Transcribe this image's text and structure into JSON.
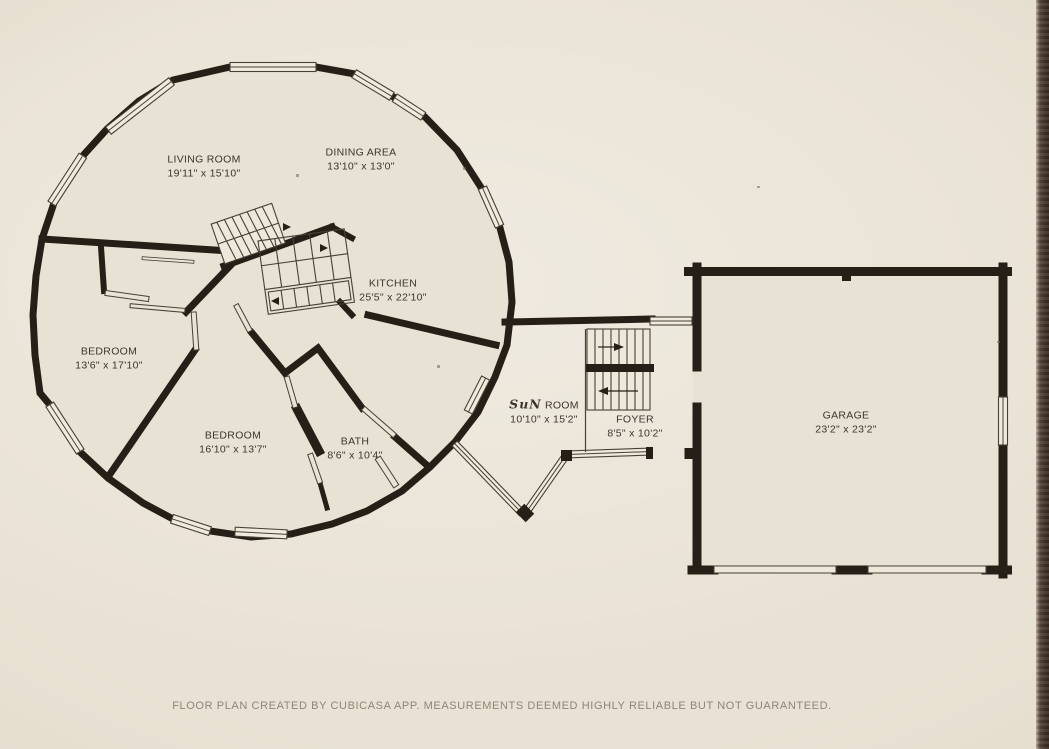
{
  "rooms": {
    "living_room": {
      "label": "LIVING ROOM",
      "dims": "19'11\" x 15'10\""
    },
    "dining_area": {
      "label": "DINING AREA",
      "dims": "13'10\" x 13'0\""
    },
    "kitchen": {
      "label": "KITCHEN",
      "dims": "25'5\" x 22'10\""
    },
    "bedroom_left": {
      "label": "BEDROOM",
      "dims": "13'6\" x 17'10\""
    },
    "bedroom_bottom": {
      "label": "BEDROOM",
      "dims": "16'10\" x 13'7\""
    },
    "bath": {
      "label": "BATH",
      "dims": "8'6\" x 10'4\""
    },
    "sun_room": {
      "label_hand": "SuN",
      "label": "ROOM",
      "dims": "10'10\" x 15'2\""
    },
    "foyer": {
      "label": "FOYER",
      "dims": "8'5\" x 10'2\""
    },
    "garage": {
      "label": "GARAGE",
      "dims": "23'2\" x 23'2\""
    }
  },
  "footer": "FLOOR PLAN CREATED BY CUBICASA APP. MEASUREMENTS DEEMED HIGHLY RELIABLE BUT NOT GUARANTEED.",
  "colors": {
    "paper": "#e6e0d2",
    "wall": "#261f17",
    "thin_line": "#464035",
    "label_text": "#3b362c",
    "footer_text": "#8d8577",
    "photo_edge": "#46382c"
  }
}
